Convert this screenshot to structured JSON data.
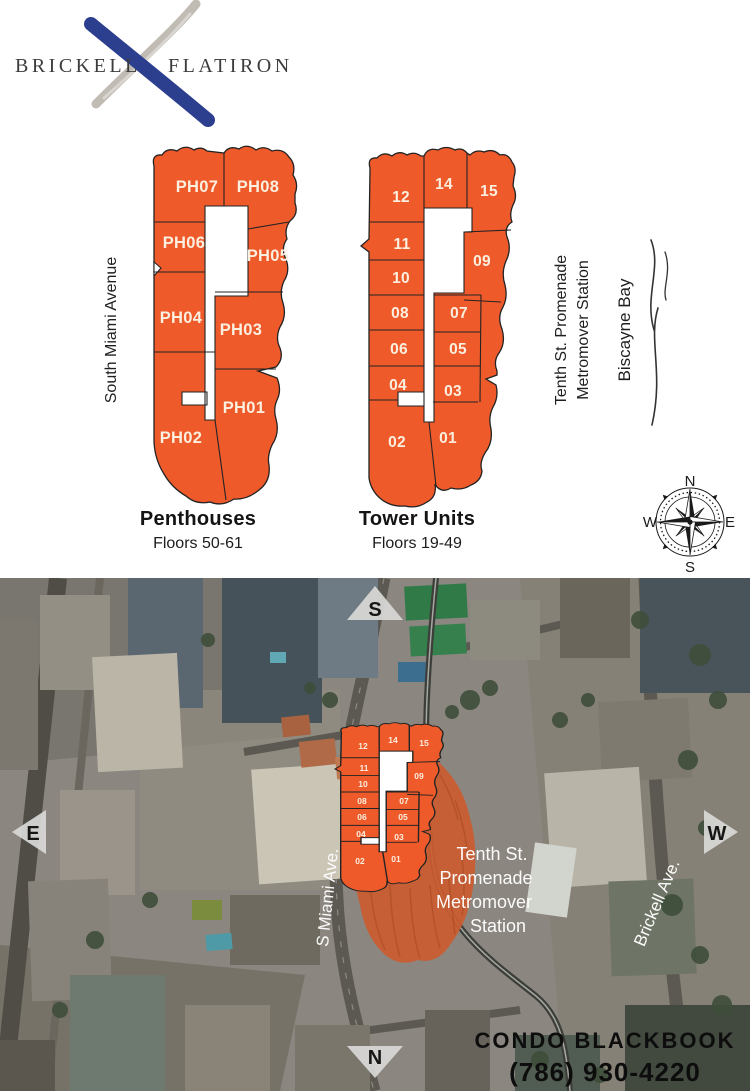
{
  "logo": {
    "brand_left": "BRICKELL",
    "brand_right": "FLATIRON"
  },
  "colors": {
    "accent_orange": "#EF5A2B",
    "logo_blue": "#2C3E8E",
    "brush_gray": "#C0BCB4",
    "unit_label_ivory": "#FBEFDF"
  },
  "top_section": {
    "street_left": "South Miami Avenue",
    "metromover_lines": [
      "Tenth St. Promenade",
      "Metromover Station"
    ],
    "bay": "Biscayne Bay",
    "compass": {
      "n": "N",
      "e": "E",
      "s": "S",
      "w": "W"
    },
    "penthouses": {
      "title": "Penthouses",
      "subtitle": "Floors 50-61",
      "units": [
        "PH07",
        "PH08",
        "PH06",
        "PH05",
        "PH04",
        "PH03",
        "PH01",
        "PH02"
      ]
    },
    "tower": {
      "title": "Tower Units",
      "subtitle": "Floors 19-49",
      "units": [
        "12",
        "14",
        "15",
        "11",
        "09",
        "10",
        "08",
        "07",
        "06",
        "05",
        "04",
        "03",
        "02",
        "01"
      ]
    }
  },
  "aerial": {
    "direction_markers": {
      "top": "S",
      "bottom": "N",
      "left": "E",
      "right": "W"
    },
    "street_labels": {
      "s_miami": "S Miami Ave.",
      "brickell": "Brickell Ave."
    },
    "station_lines": [
      "Tenth St.",
      "Promenade",
      "Metromover",
      "Station"
    ],
    "mini_plan_units": [
      "12",
      "14",
      "15",
      "11",
      "09",
      "10",
      "08",
      "07",
      "06",
      "05",
      "04",
      "03",
      "02",
      "01"
    ],
    "branding": {
      "company": "CONDO BLACKBOOK",
      "phone": "(786) 930-4220"
    }
  }
}
